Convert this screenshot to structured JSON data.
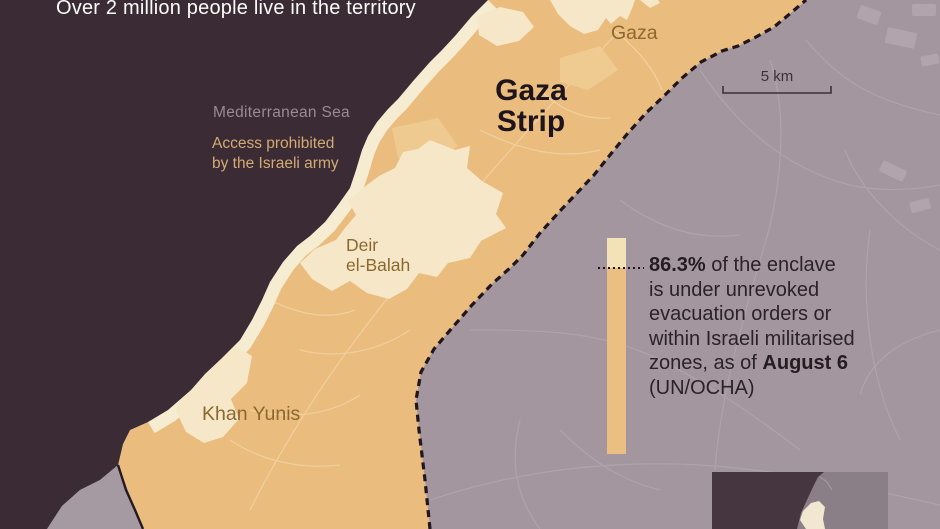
{
  "header": {
    "title": "Over 2 million people live in the territory"
  },
  "map": {
    "sea_label": "Mediterranean Sea",
    "access_note": {
      "line1": "Access prohibited",
      "line2": "by the Israeli army"
    },
    "region_label": {
      "line1": "Gaza",
      "line2": "Strip"
    },
    "cities": {
      "gaza": "Gaza",
      "deir_el_balah": {
        "line1": "Deir",
        "line2": "el-Balah"
      },
      "khan_yunis": "Khan Yunis"
    },
    "scale": {
      "label": "5 km",
      "km": 5
    }
  },
  "callout": {
    "stat": "86.3%",
    "line1_rest": " of the enclave",
    "line2": "is under unrevoked",
    "line3": "evacuation orders or",
    "line4": "within Israeli militarised",
    "line5_pre": "zones, as of ",
    "line5_bold": "August 6",
    "line6": "(UN/OCHA)",
    "evacuated_or_militarised_pct": 86.3
  },
  "legend_bar": {
    "evacuated_pct": 86.3,
    "remaining_pct": 13.7
  },
  "colors": {
    "sea": "#3a2b34",
    "israel_land": "#a3969f",
    "egypt_land": "#a59aa2",
    "gaza_strip": "#eabc7e",
    "coastal_zone": "#f6ecd2",
    "unaffected_patch": "#f5e7c8",
    "legend_remaining": "#f3e1b8",
    "legend_evacuated": "#eabf81",
    "border_dashed": "#20161c",
    "city_label": "#8d682e",
    "access_note_text": "#d3ab73",
    "sea_label_text": "#9a8a93",
    "title_text": "#fdfcfa",
    "callout_text": "#2b2228"
  }
}
